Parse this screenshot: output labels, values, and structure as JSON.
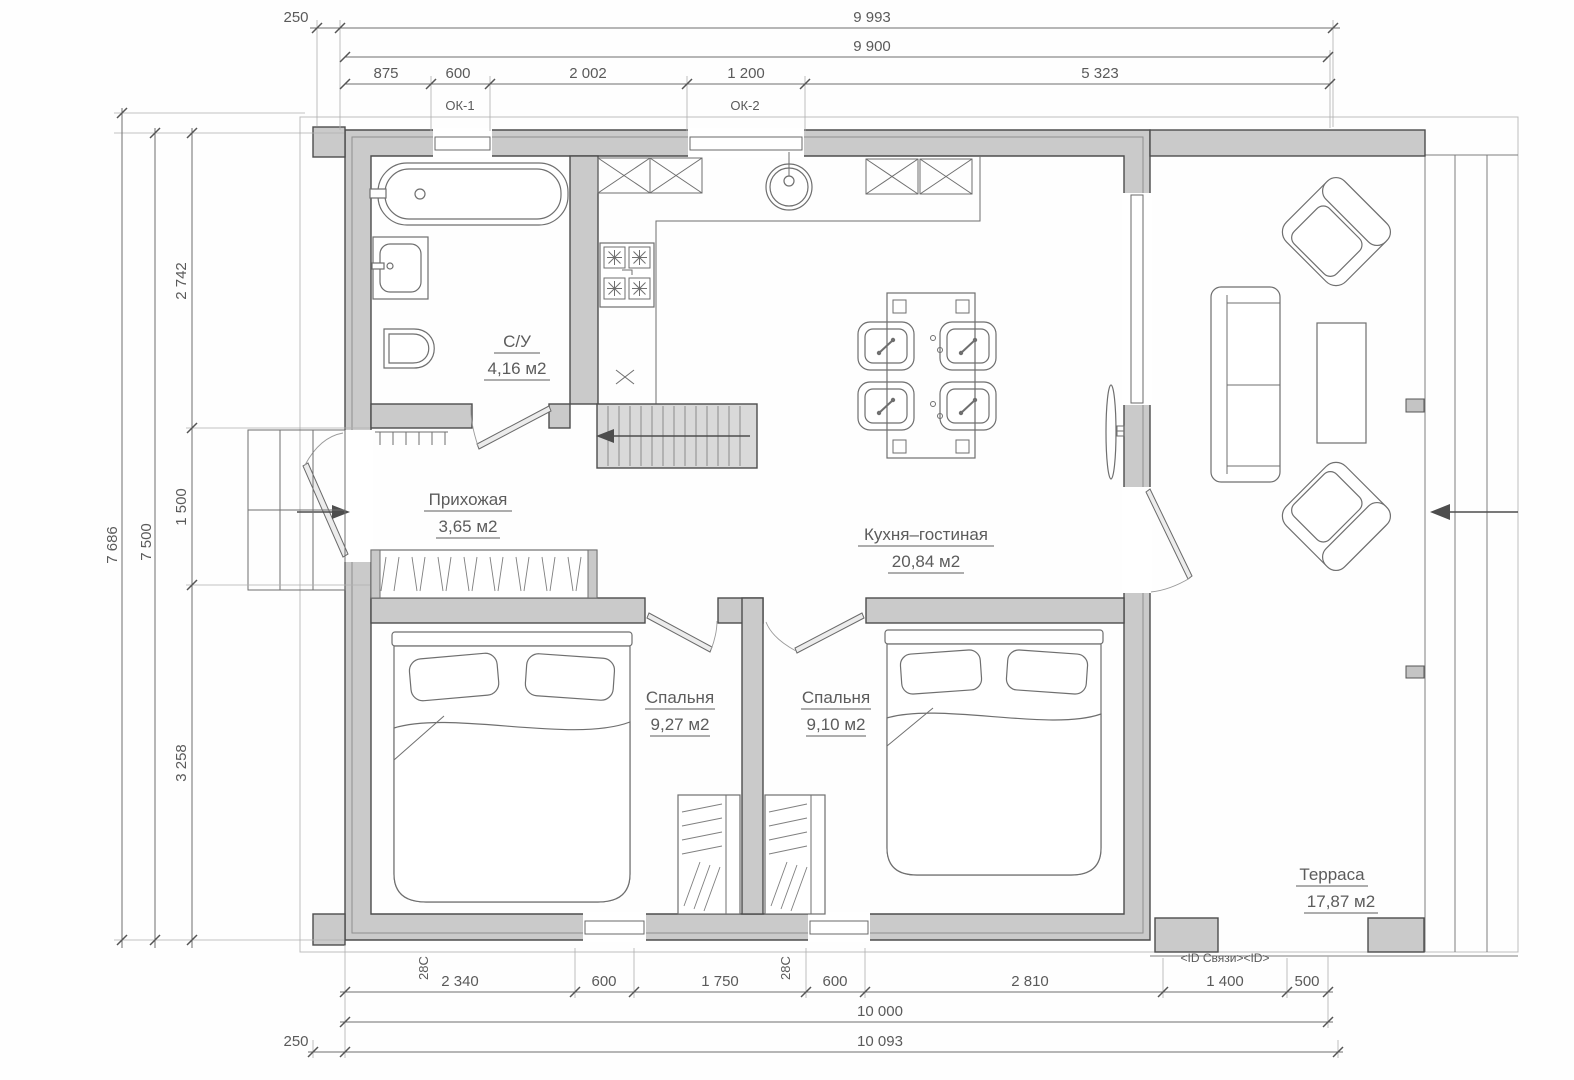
{
  "colors": {
    "wall_fill": "#cacaca",
    "wall_line": "#4d4d4d",
    "dim_text": "#5a5a5a",
    "background": "#ffffff"
  },
  "dims": {
    "top": {
      "offset": "250",
      "overall": "9 993",
      "axis": "9 900",
      "seg": [
        "875",
        "600",
        "2 002",
        "1 200",
        "5 323"
      ]
    },
    "left": {
      "overall": "7 686",
      "axis": "7 500",
      "seg": [
        "2 742",
        "1 500",
        "3 258"
      ]
    },
    "bottom": {
      "seg": [
        "2 340",
        "600",
        "1 750",
        "600",
        "2 810",
        "1 400",
        "500"
      ],
      "axis": "10 000",
      "offset": "250",
      "overall": "10 093"
    }
  },
  "windows": {
    "ok1": "ОК-1",
    "ok2": "ОК-2"
  },
  "marks": {
    "s1": "28С",
    "s2": "28С",
    "id": "<ID Связи><ID>"
  },
  "rooms": {
    "wc": {
      "name": "С/У",
      "area": "4,16 м2"
    },
    "hall": {
      "name": "Прихожая",
      "area": "3,65 м2"
    },
    "kitchen": {
      "name": "Кухня–гостиная",
      "area": "20,84 м2"
    },
    "bedroom1": {
      "name": "Спальня",
      "area": "9,27 м2"
    },
    "bedroom2": {
      "name": "Спальня",
      "area": "9,10 м2"
    },
    "terrace": {
      "name": "Терраса",
      "area": "17,87 м2"
    }
  }
}
